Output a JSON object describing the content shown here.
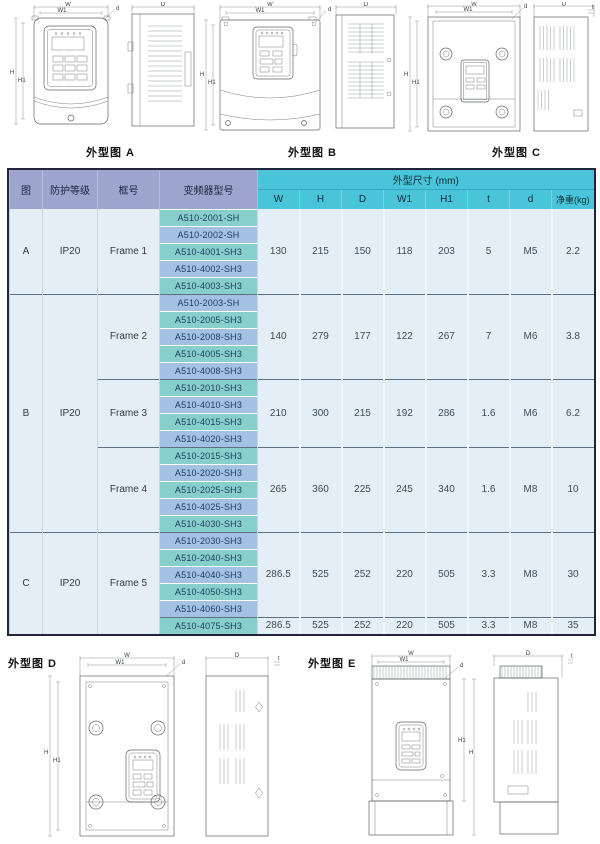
{
  "drawings": {
    "dim_labels": {
      "w": "W",
      "w1": "W1",
      "h": "H",
      "h1": "H1",
      "depth": "D",
      "screw": "d",
      "thickness": "t"
    },
    "a": {
      "caption": "外型图 A"
    },
    "b": {
      "caption": "外型图 B"
    },
    "c": {
      "caption": "外型图 C"
    },
    "d": {
      "caption": "外型图 D"
    },
    "e": {
      "caption": "外型图 E"
    }
  },
  "table": {
    "headers": {
      "figure": "图",
      "protection": "防护等级",
      "frame": "框号",
      "model": "变频器型号",
      "dims": "外型尺寸 (mm)",
      "w": "W",
      "h": "H",
      "d": "D",
      "w1": "W1",
      "h1": "H1",
      "t": "t",
      "screw": "d",
      "weight": "净重(kg)"
    },
    "sections": [
      {
        "figure": "A",
        "protection": "IP20"
      },
      {
        "figure": "B",
        "protection": "IP20"
      },
      {
        "figure": "C",
        "protection": "IP20"
      }
    ],
    "frames": [
      {
        "label": "Frame 1",
        "models": [
          "A510-2001-SH",
          "A510-2002-SH",
          "A510-4001-SH3",
          "A510-4002-SH3",
          "A510-4003-SH3"
        ],
        "dims": [
          "130",
          "215",
          "150",
          "118",
          "203",
          "5",
          "M5",
          "2.2"
        ]
      },
      {
        "label": "Frame 2",
        "models": [
          "A510-2003-SH",
          "A510-2005-SH3",
          "A510-2008-SH3",
          "A510-4005-SH3",
          "A510-4008-SH3"
        ],
        "dims": [
          "140",
          "279",
          "177",
          "122",
          "267",
          "7",
          "M6",
          "3.8"
        ]
      },
      {
        "label": "Frame 3",
        "models": [
          "A510-2010-SH3",
          "A510-4010-SH3",
          "A510-4015-SH3",
          "A510-4020-SH3"
        ],
        "dims": [
          "210",
          "300",
          "215",
          "192",
          "286",
          "1.6",
          "M6",
          "6.2"
        ]
      },
      {
        "label": "Frame 4",
        "models": [
          "A510-2015-SH3",
          "A510-2020-SH3",
          "A510-2025-SH3",
          "A510-4025-SH3",
          "A510-4030-SH3"
        ],
        "dims": [
          "265",
          "360",
          "225",
          "245",
          "340",
          "1.6",
          "M8",
          "10"
        ]
      },
      {
        "label": "Frame 5",
        "models": [
          "A510-2030-SH3",
          "A510-2040-SH3",
          "A510-4040-SH3",
          "A510-4050-SH3",
          "A510-4060-SH3"
        ],
        "dims": [
          "286.5",
          "525",
          "252",
          "220",
          "505",
          "3.3",
          "M8",
          "30"
        ],
        "extra_model": "A510-4075-SH3",
        "extra_dims": [
          "286.5",
          "525",
          "252",
          "220",
          "505",
          "3.3",
          "M8",
          "35"
        ]
      }
    ]
  },
  "colors": {
    "header_cyan": "#49C4D8",
    "header_lavender": "#9DA4CE",
    "model_teal": "#86CFCB",
    "model_blue": "#A2C1E3",
    "row_bg": "#E3EEF6",
    "table_border": "#23233c"
  }
}
